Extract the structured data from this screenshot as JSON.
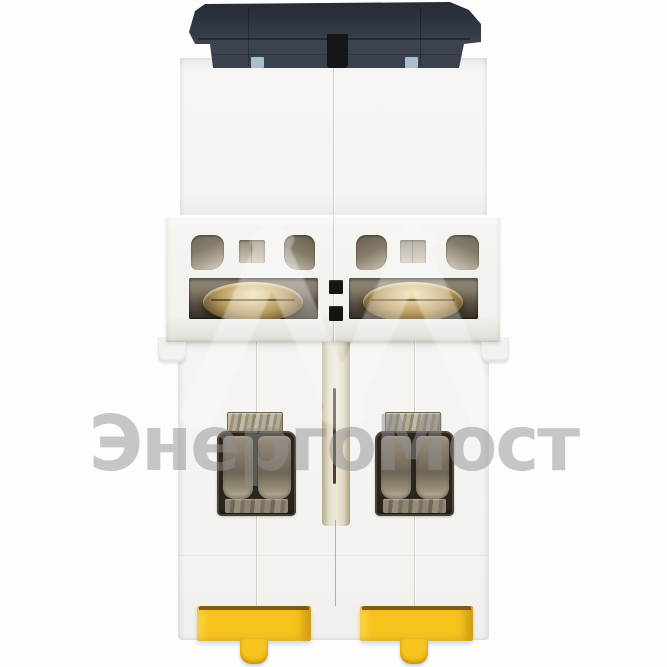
{
  "photo": {
    "subject": "two-pole modular circuit breaker, rear bottom view",
    "watermark": {
      "text": "ЭнергоМост",
      "color": "#8f8f8f"
    }
  },
  "colors": {
    "background": "#fdfdfd",
    "cap_dark": "#333a47",
    "housing_white": "#f4f3f0",
    "mount_tab_blue": "#a9bfce",
    "vent_interior_dark": "#6f6856",
    "vent_interior_light": "#d9d3c3",
    "screw_brass": "#c9ae72",
    "terminal_dark": "#2b251d",
    "clamp_metal": "#8d8471",
    "clip_yellow": "#f7c41d",
    "clip_shadow_line": "#6e4a10",
    "groove_tan": "#e2dcc8"
  }
}
